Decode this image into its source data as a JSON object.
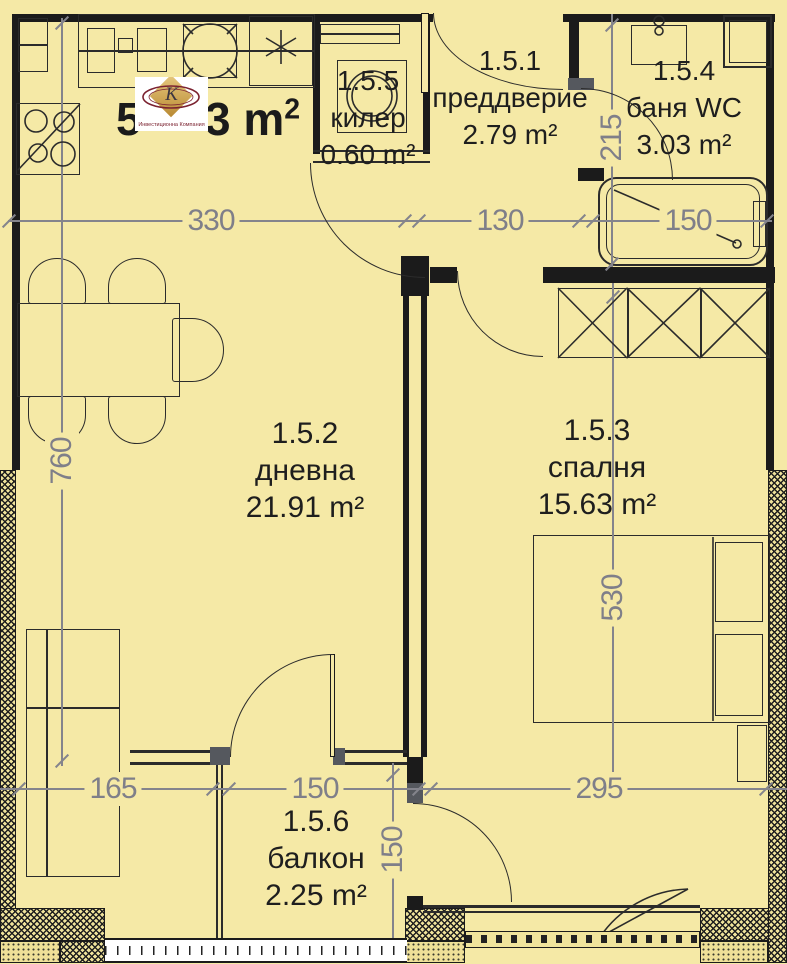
{
  "watermark": {
    "company": "Инвестиционна Компания",
    "monogram": "К"
  },
  "total_area": {
    "prefix": "5",
    "suffix_main": "3 m",
    "suffix_sup": "2"
  },
  "rooms": [
    {
      "id": "1.5.1",
      "name": "преддверие",
      "area": "2.79 m²"
    },
    {
      "id": "1.5.2",
      "name": "дневна",
      "area": "21.91 m²"
    },
    {
      "id": "1.5.3",
      "name": "спалня",
      "area": "15.63 m²"
    },
    {
      "id": "1.5.4",
      "name": "баня WC",
      "area": "3.03 m²"
    },
    {
      "id": "1.5.5",
      "name": "килер",
      "area": "0.60 m²"
    },
    {
      "id": "1.5.6",
      "name": "балкон",
      "area": "2.25 m²"
    }
  ],
  "dimensions": {
    "top": [
      "330",
      "130",
      "150"
    ],
    "vertical_left": "760",
    "vertical_hall": "215",
    "vertical_bedroom": "530",
    "bottom": [
      "165",
      "150",
      "295"
    ],
    "vertical_balcony": "150"
  },
  "colors": {
    "background": "#F5E9A6",
    "wall": "#1B1B1B",
    "dimension_text": "#7F7F89",
    "label_text": "#1E1E1E",
    "jamb": "#55585E",
    "logo_accent": "#7B2230",
    "logo_gold": "#C9A961"
  }
}
